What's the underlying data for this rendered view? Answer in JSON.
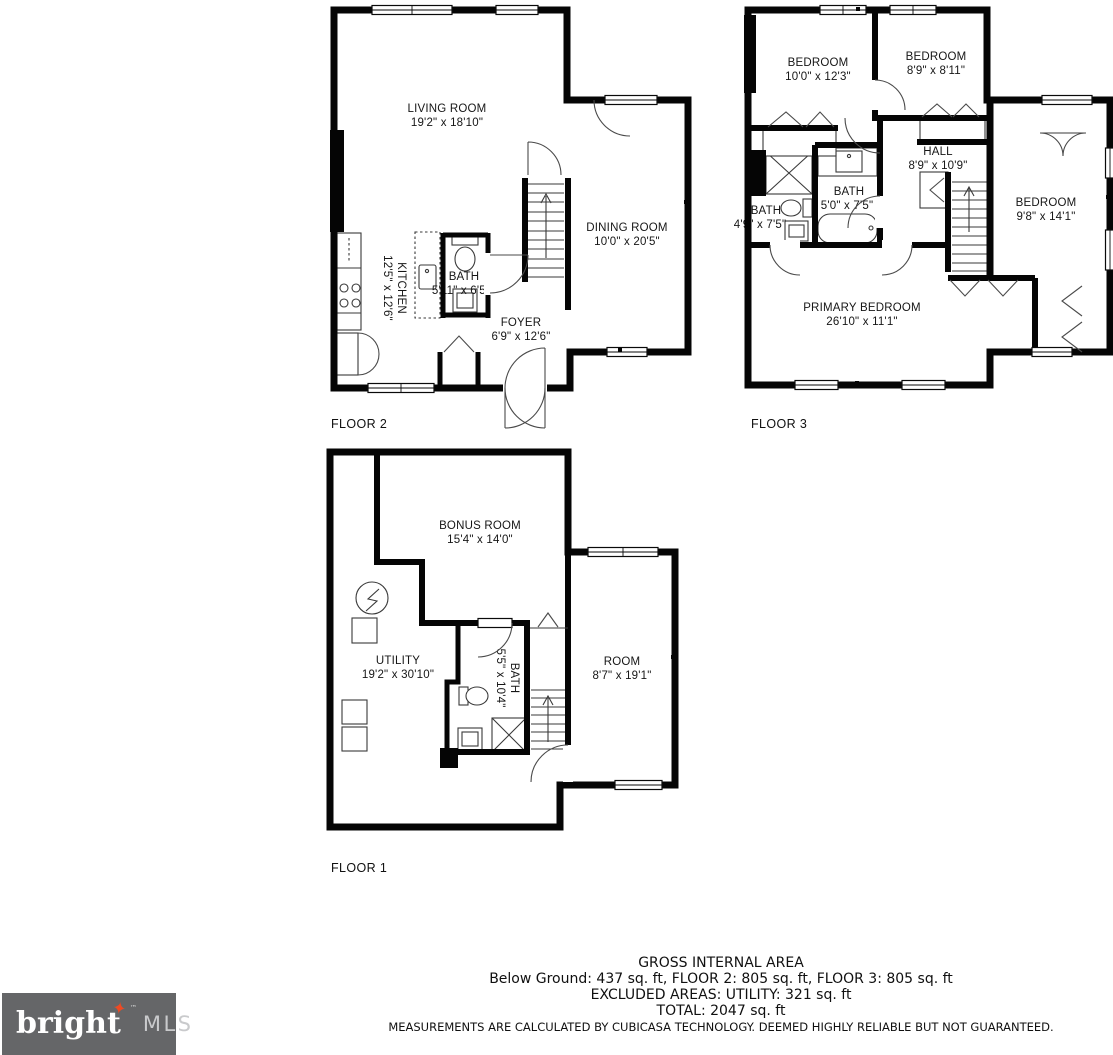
{
  "floors": {
    "floor2": {
      "label": "FLOOR 2",
      "rooms": {
        "living": {
          "name": "LIVING ROOM",
          "dims": "19'2\" x 18'10\""
        },
        "dining": {
          "name": "DINING ROOM",
          "dims": "10'0\" x 20'5\""
        },
        "kitchen": {
          "name": "KITCHEN",
          "dims": "12'5\" x 12'6\""
        },
        "bath": {
          "name": "BATH",
          "dims": "5'11\" x 6'5\""
        },
        "foyer": {
          "name": "FOYER",
          "dims": "6'9\" x 12'6\""
        }
      }
    },
    "floor3": {
      "label": "FLOOR 3",
      "rooms": {
        "bedroom1": {
          "name": "BEDROOM",
          "dims": "10'0\" x 12'3\""
        },
        "bedroom2": {
          "name": "BEDROOM",
          "dims": "8'9\" x 8'11\""
        },
        "hall": {
          "name": "HALL",
          "dims": "8'9\" x 10'9\""
        },
        "bath_center": {
          "name": "BATH",
          "dims": "5'0\" x 7'5\""
        },
        "bath_left": {
          "name": "BATH",
          "dims": "4'9\" x 7'5\""
        },
        "bedroom3": {
          "name": "BEDROOM",
          "dims": "9'8\" x 14'1\""
        },
        "primary": {
          "name": "PRIMARY BEDROOM",
          "dims": "26'10\" x 11'1\""
        }
      }
    },
    "floor1": {
      "label": "FLOOR 1",
      "rooms": {
        "bonus": {
          "name": "BONUS ROOM",
          "dims": "15'4\" x 14'0\""
        },
        "utility": {
          "name": "UTILITY",
          "dims": "19'2\" x 30'10\""
        },
        "bath": {
          "name": "BATH",
          "dims": "5'5\" x 10'4\""
        },
        "room": {
          "name": "ROOM",
          "dims": "8'7\" x 19'1\""
        }
      }
    }
  },
  "summary": {
    "title": "GROSS INTERNAL AREA",
    "line1": "Below Ground: 437 sq. ft, FLOOR 2: 805 sq. ft, FLOOR 3: 805 sq. ft",
    "line2": "EXCLUDED AREAS: UTILITY: 321 sq. ft",
    "line3": "TOTAL: 2047 sq. ft",
    "disclaimer": "MEASUREMENTS ARE CALCULATED BY CUBICASA TECHNOLOGY. DEEMED HIGHLY RELIABLE BUT NOT GUARANTEED."
  },
  "logo": {
    "brand": "bright",
    "star_glyph": "✦",
    "tm": "™",
    "suffix": "MLS",
    "bg_color": "#656668",
    "star_color": "#ee4a23",
    "text_color": "#ffffff",
    "suffix_color": "#c9cacc"
  },
  "colors": {
    "walls": "#050505",
    "background": "#ffffff"
  }
}
